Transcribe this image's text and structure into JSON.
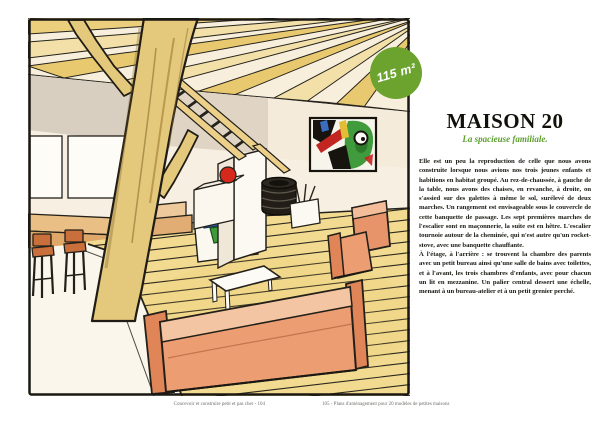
{
  "book_page": {
    "badge": {
      "label": "115 m²",
      "color": "#6ba32e"
    },
    "article": {
      "title": "MAISON 20",
      "subtitle": "La spacieuse familiale.",
      "paragraphs": {
        "p1": "Elle est un peu la reproduction de celle que nous avons construite lorsque nous avions nos trois jeunes enfants et habitions en habitat groupé. Au rez-de-chaussée, à gauche de la table, nous avons des chaises, en revanche, à droite, on s'assied sur des galettes à même le sol, surélevé de deux marches. Un rangement est envisageable sous le couvercle de cette banquette de passage. Les sept premières marches de l'escalier sont en maçonnerie, la suite est en hêtre. L'escalier tournoie autour de la cheminée, qui n'est autre qu'un rocket-stove, avec une banquette chauffante.",
        "p2": "À l'étage, à l'arrière : se trouvent la chambre des parents avec un petit bureau ainsi qu'une salle de bains avec toilettes, et à l'avant, les trois chambres d'enfants, avec pour chacun un lit en mezzanine. Un palier central dessert une échelle, menant à un bureau-atelier et à un petit grenier perché."
      }
    },
    "footers": {
      "left": "Concevoir et construire petit et pas cher - 104",
      "right": "105 - Plans d'aménagement pour 20 modèles de petites maisons"
    },
    "illustration": {
      "description": "Aquarelle d'un intérieur de maison : charpente bois apparente, tronc d'arbre porteur, échelle vers la mezzanine, cheminée rocket-stove en maçonnerie blanche avec poêle noir, tableau abstrait, canapé et fauteuil orange, tabourets de bar, banquette à coussins et plancher bois.",
      "colors": {
        "wood": "#e7c96f",
        "wall": "#d9cfc0",
        "sofa": "#ec9e72",
        "stove": "#221d17",
        "accent_green": "#6ba32e"
      }
    }
  }
}
